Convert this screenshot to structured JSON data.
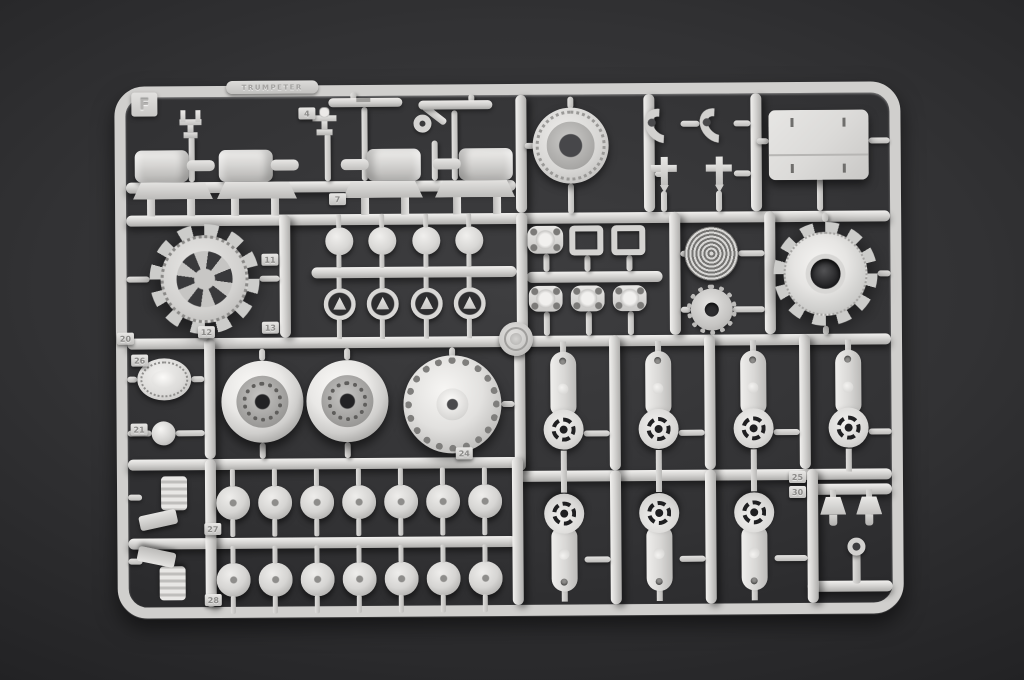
{
  "scene": {
    "type": "photograph",
    "subject": "light-gray injection-molded plastic model-kit parts sprue on a dark charcoal surface",
    "background_color": "#2b2b2d",
    "plastic_color": "#d6d5d3"
  },
  "sprue": {
    "letter": "F",
    "brand_text": "TRUMPETER"
  },
  "tags": {
    "t4": "4",
    "t7": "7",
    "t11": "11",
    "t12": "12",
    "t13": "13",
    "t20": "20",
    "t21": "21",
    "t24": "24",
    "t25": "25",
    "t26": "26",
    "t27": "27",
    "t28": "28",
    "t30": "30"
  },
  "part_groups": [
    {
      "name": "hull-clamp",
      "count": 2
    },
    {
      "name": "angle-lever",
      "count": 1
    },
    {
      "name": "cylindrical-rod",
      "count": 2
    },
    {
      "name": "idler-wheel-hub",
      "count": 1
    },
    {
      "name": "tow-hook",
      "count": 2
    },
    {
      "name": "t-bracket",
      "count": 2
    },
    {
      "name": "flat-roof-plate",
      "count": 1
    },
    {
      "name": "cylinder-mount",
      "count": 4
    },
    {
      "name": "spoked-drive-sprocket",
      "count": 1
    },
    {
      "name": "round-cap-disc",
      "count": 4
    },
    {
      "name": "ring-retainer",
      "count": 4
    },
    {
      "name": "oval-mounting-plate",
      "count": 4
    },
    {
      "name": "rectangular-frame",
      "count": 2
    },
    {
      "name": "round-engine-grille",
      "count": 1
    },
    {
      "name": "splined-hub",
      "count": 1
    },
    {
      "name": "domed-drive-sprocket",
      "count": 1
    },
    {
      "name": "oval-access-hatch",
      "count": 1
    },
    {
      "name": "ball-joint",
      "count": 1
    },
    {
      "name": "dished-road-wheel",
      "count": 2
    },
    {
      "name": "final-drive-housing",
      "count": 1
    },
    {
      "name": "suspension-swing-arm",
      "count": 7
    },
    {
      "name": "road-wheel-hub-cap",
      "count": 14
    },
    {
      "name": "shock-absorber-cylinder",
      "count": 2
    },
    {
      "name": "funnel-bucket",
      "count": 2
    },
    {
      "name": "small-valve-fitting",
      "count": 1
    },
    {
      "name": "material-stamp-medallion",
      "count": 1
    }
  ]
}
